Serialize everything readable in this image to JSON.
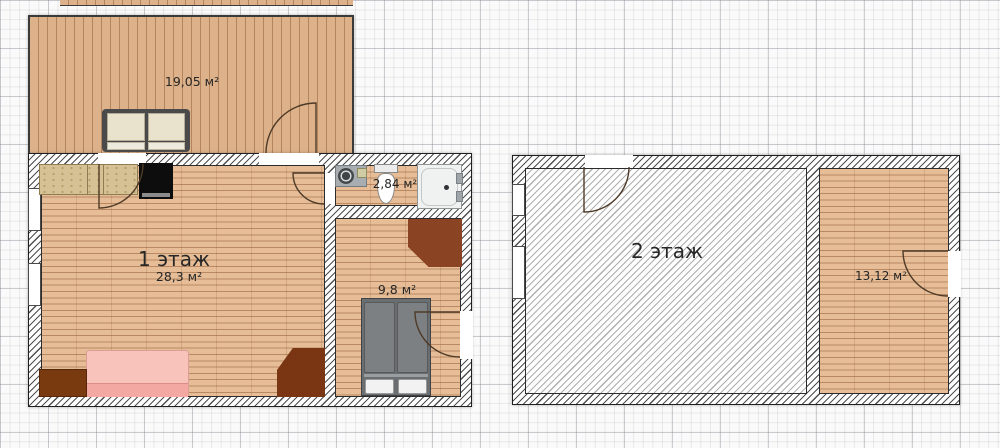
{
  "floor1": {
    "terrace": {
      "area_label": "19,05 м²"
    },
    "living_room": {
      "title": "1 этаж",
      "area_label": "28,3 м²"
    },
    "bathroom": {
      "area_label": "2,84 м²"
    },
    "bedroom": {
      "area_label": "9,8 м²"
    }
  },
  "floor2": {
    "hall": {
      "title": "2 этаж"
    },
    "room": {
      "area_label": "13,12 м²"
    }
  },
  "furniture_icons": {
    "terrace": [
      "sofa"
    ],
    "living_room": [
      "kitchen-counter",
      "stove",
      "pink-sofa",
      "cabinet",
      "corner-wardrobe"
    ],
    "bathroom": [
      "washing-machine",
      "sink",
      "toilet",
      "shower-tray"
    ],
    "bedroom": [
      "corner-wardrobe",
      "double-bed"
    ]
  },
  "colors": {
    "wood_floor": "#e6bd97",
    "wood_plank_line": "#b98a63",
    "terrace_floor": "#ddb28a",
    "wall_outline": "#1f1f1f",
    "wardrobe_brown_dark": "#7a3513",
    "wardrobe_brown": "#8a4423",
    "sofa_pink": "#f6b8b0",
    "bed_gray": "#6a6e70",
    "stove_black": "#0d0d0d",
    "kitchen_counter_tan": "#d5c193",
    "fixture_gray": "#a7adb0",
    "grid_line": "#c9c9cf"
  }
}
